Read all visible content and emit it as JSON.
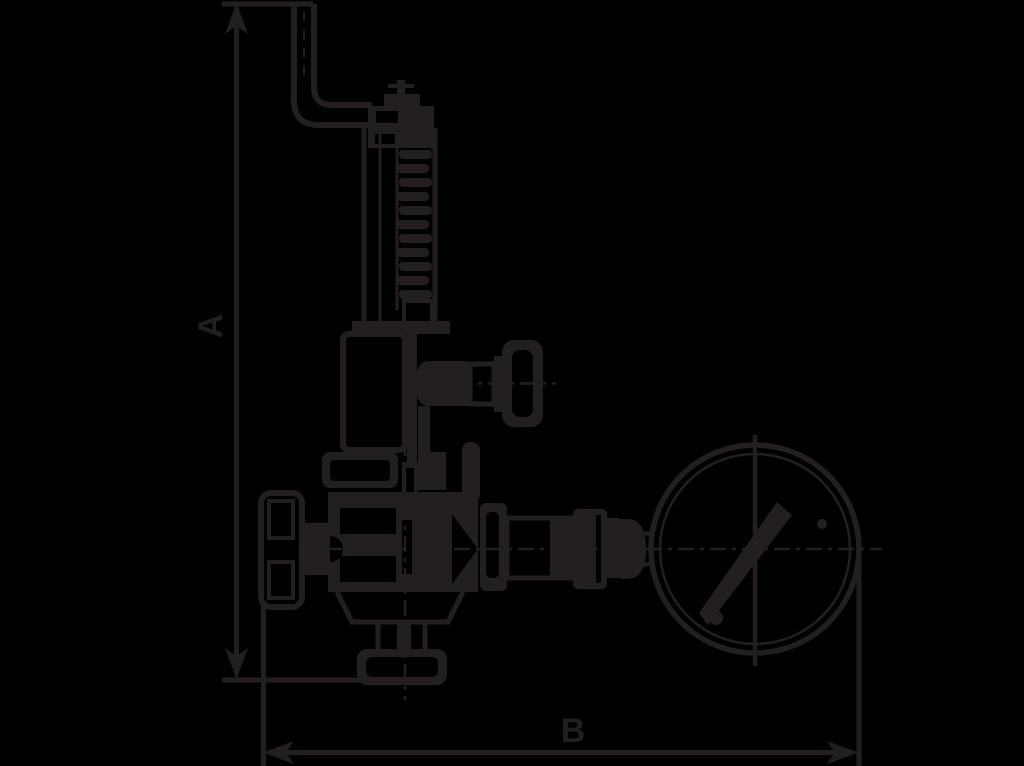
{
  "canvas": {
    "width": 1024,
    "height": 766,
    "background_color": "#000000",
    "ink_color": "#231f20"
  },
  "figure": {
    "type": "technical-line-drawing",
    "subject": "relief valve with top lever, side handwheel and pressure gauge"
  },
  "dimensions": {
    "vertical": {
      "label": "A"
    },
    "horizontal": {
      "label": "B"
    }
  }
}
